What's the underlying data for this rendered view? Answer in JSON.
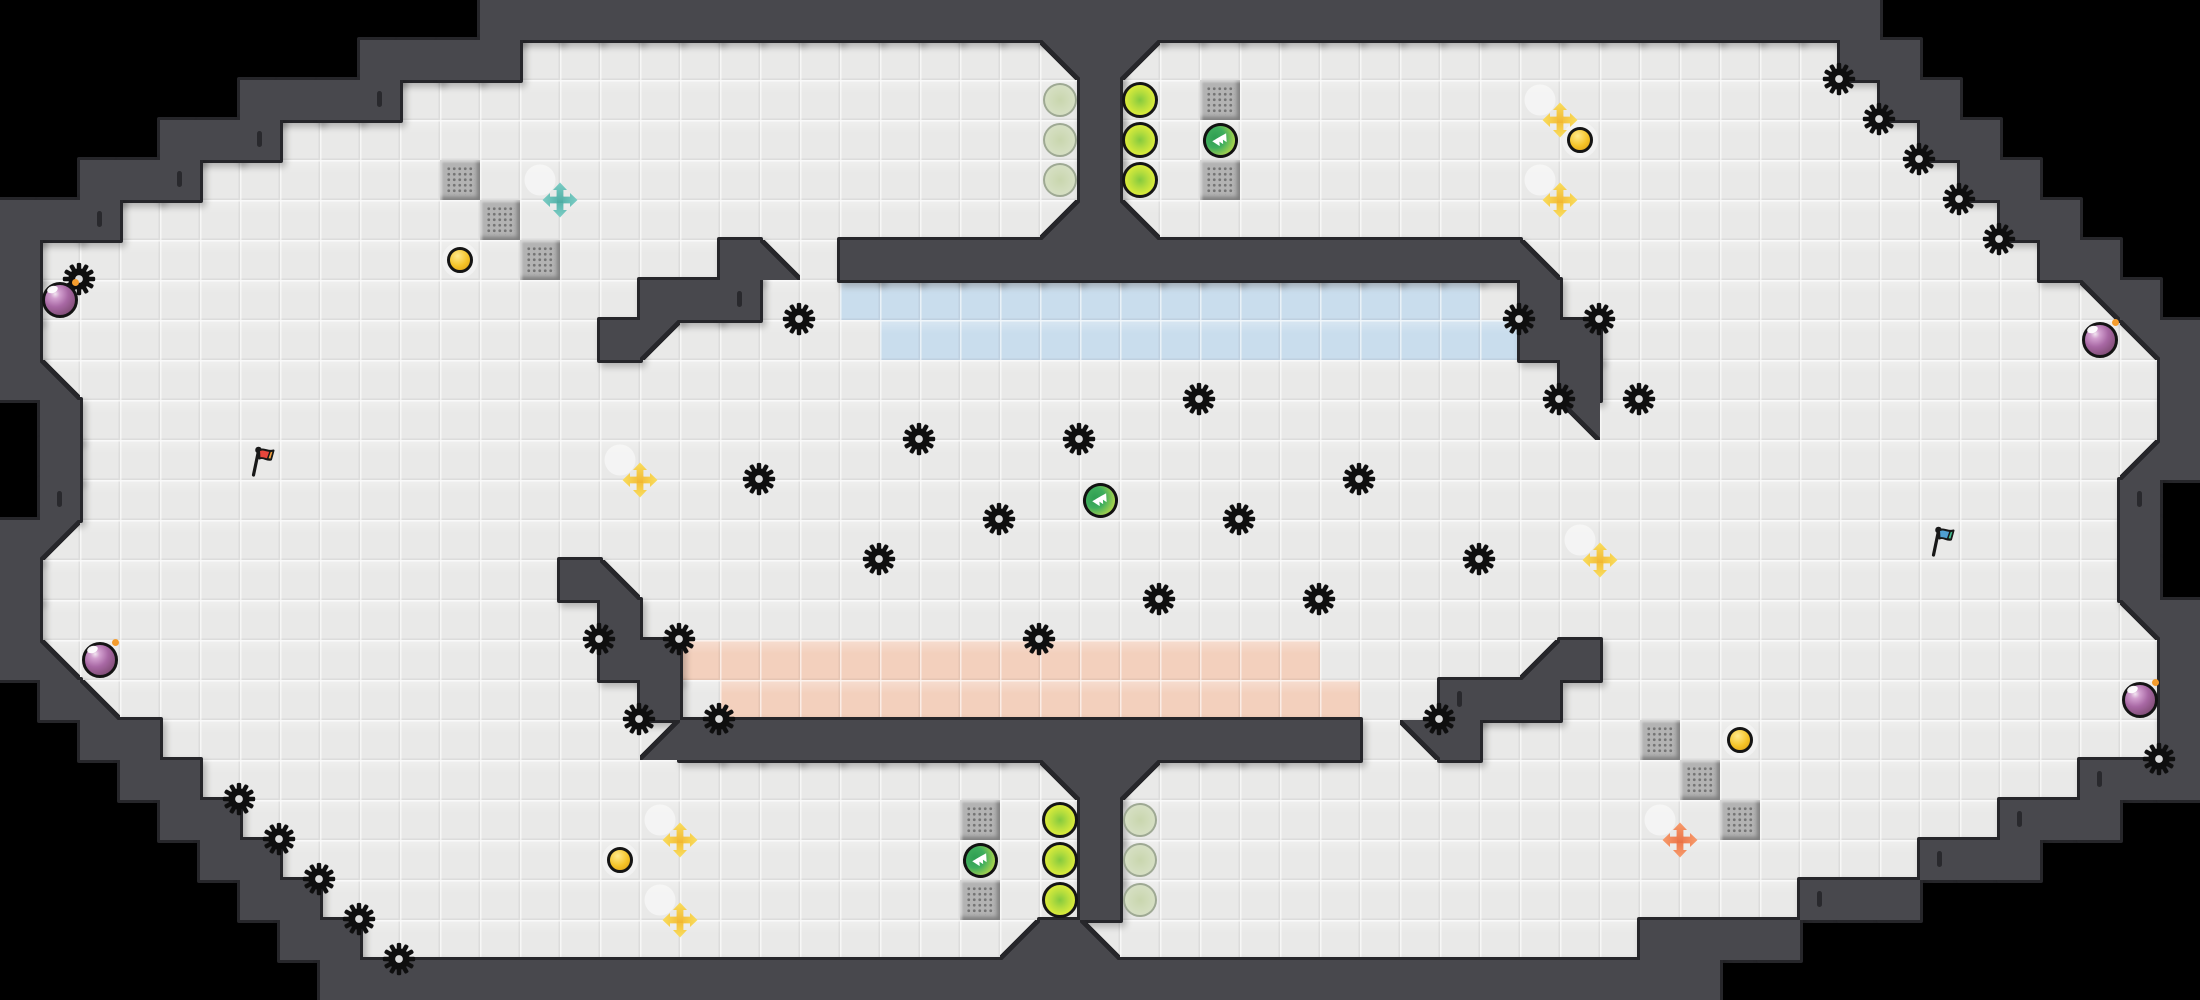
{
  "meta": {
    "title": "top-down capture-the-flag arena map",
    "width_px": 2200,
    "height_px": 1000,
    "tile_px": 40,
    "cols": 55,
    "rows": 25
  },
  "colors": {
    "background": "#000000",
    "wall": "#48484d",
    "wall_edge": "#26262a",
    "floor": "#e9e9e8",
    "blue_zone": "#c9dded",
    "pink_zone": "#f3d0bd",
    "gate_fill": "#b3b3b3",
    "gate_dot": "#757575",
    "spike": "#0f0f0f",
    "spike_hole": "#dcdcdc",
    "bomb_ring": "#141414",
    "bomb_fuse": "#f59d2e",
    "button_gold": "#f5c327",
    "tick": "#29292d",
    "boost_yellow_1": "#f9dc5c",
    "boost_yellow_2": "#ec9c14",
    "boost_red_1": "#f79a6b",
    "boost_red_2": "#e0542a",
    "boost_blue_1": "#7accc4",
    "boost_blue_2": "#2f968b",
    "flag_red_cloth": "#e8463c",
    "flag_red_tip": "#f5a13d",
    "flag_blue_cloth": "#4f9fd3",
    "flag_blue_tip": "#43bf90"
  },
  "map": {
    "legend": {
      " ": "outside-void",
      "#": "wall",
      ".": "floor",
      "b": "blue-team-zone-tile",
      "p": "red-team-zone-tile",
      "1": "wall-diagonal-upper-left",
      "2": "wall-diagonal-upper-right",
      "3": "wall-diagonal-lower-right",
      "4": "wall-diagonal-lower-left"
    },
    "grid": [
      "            ###################################        ",
      "         ####.............2#1.................##       ",
      "      ####.................#...................##      ",
      "    ###....................#....................##     ",
      "  ###......................#.....................##    ",
      "###.......................3#4.....................##   ",
      "#.................#4.#################4............##  ",
      "#...............###..bbbbbbbbbbbbbbbb.#.............2# ",
      "#..............#1.....bbbbbbbbbbbbbbbb##.............2#",
      "#4.....................................#..............#",
      " #.....................................2..............#",
      " #...................................................3#",
      " #...................................................# ",
      "#1...................................................# ",
      "#.............#4.....................................# ",
      "#..............#.....................................2#",
      "#4.............##pppppppppppppppp.....3#..............#",
      " #4.............#.pppppppppppppppp..###...............#",
      "  ##............3#################.2#.................#",
      "   ##.....................2#1.......................###",
      "    ##.....................#......................###  ",
      "     ##....................#....................###    ",
      "      ##...................#.................###       ",
      "       ##................3#4.............####         ",
      "        ###################################            "
    ]
  },
  "objects": {
    "spikes": [
      [
        1,
        6
      ],
      [
        53,
        18
      ],
      [
        5,
        19
      ],
      [
        6,
        20
      ],
      [
        7,
        21
      ],
      [
        8,
        22
      ],
      [
        9,
        23
      ],
      [
        45,
        1
      ],
      [
        46,
        2
      ],
      [
        47,
        3
      ],
      [
        48,
        4
      ],
      [
        49,
        5
      ],
      [
        19,
        7
      ],
      [
        37,
        7
      ],
      [
        39,
        7
      ],
      [
        38,
        9
      ],
      [
        40,
        9
      ],
      [
        29,
        9
      ],
      [
        22,
        10
      ],
      [
        26,
        10
      ],
      [
        18,
        11
      ],
      [
        33,
        11
      ],
      [
        24,
        12
      ],
      [
        30,
        12
      ],
      [
        21,
        13
      ],
      [
        36,
        13
      ],
      [
        28,
        14
      ],
      [
        32,
        14
      ],
      [
        25,
        15
      ],
      [
        14,
        15
      ],
      [
        16,
        15
      ],
      [
        15,
        17
      ],
      [
        17,
        17
      ],
      [
        35,
        17
      ]
    ],
    "bombs": [
      [
        1,
        7
      ],
      [
        2,
        16
      ],
      [
        52,
        8
      ],
      [
        53,
        17
      ]
    ],
    "buttons": [
      [
        11,
        6
      ],
      [
        39,
        3
      ],
      [
        15,
        21
      ],
      [
        43,
        18
      ]
    ],
    "gates": [
      [
        11,
        4
      ],
      [
        12,
        5
      ],
      [
        13,
        6
      ],
      [
        30,
        2
      ],
      [
        30,
        4
      ],
      [
        24,
        20
      ],
      [
        24,
        22
      ],
      [
        41,
        18
      ],
      [
        42,
        19
      ],
      [
        43,
        20
      ]
    ],
    "powerups": [
      [
        30,
        3
      ],
      [
        27,
        12
      ],
      [
        24,
        21
      ]
    ],
    "boosts": {
      "yellow": [
        [
          38,
          2
        ],
        [
          38,
          4
        ],
        [
          15,
          11
        ],
        [
          39,
          13
        ],
        [
          16,
          20
        ],
        [
          16,
          22
        ]
      ],
      "red": [
        [
          41,
          20
        ]
      ],
      "blue": [
        [
          13,
          4
        ]
      ]
    },
    "flags": {
      "red": [
        6,
        11
      ],
      "blue": [
        48,
        13
      ]
    },
    "orbs": {
      "bright": [
        [
          28,
          2
        ],
        [
          28,
          3
        ],
        [
          28,
          4
        ],
        [
          26,
          20
        ],
        [
          26,
          21
        ],
        [
          26,
          22
        ]
      ],
      "faded": [
        [
          26,
          2
        ],
        [
          26,
          3
        ],
        [
          26,
          4
        ],
        [
          28,
          20
        ],
        [
          28,
          21
        ],
        [
          28,
          22
        ]
      ]
    },
    "wall_ticks": [
      [
        2,
        5
      ],
      [
        4,
        4
      ],
      [
        6,
        3
      ],
      [
        9,
        2
      ],
      [
        52,
        19
      ],
      [
        50,
        20
      ],
      [
        48,
        21
      ],
      [
        45,
        22
      ],
      [
        18,
        7
      ],
      [
        36,
        17
      ],
      [
        1,
        12
      ],
      [
        53,
        12
      ]
    ]
  }
}
